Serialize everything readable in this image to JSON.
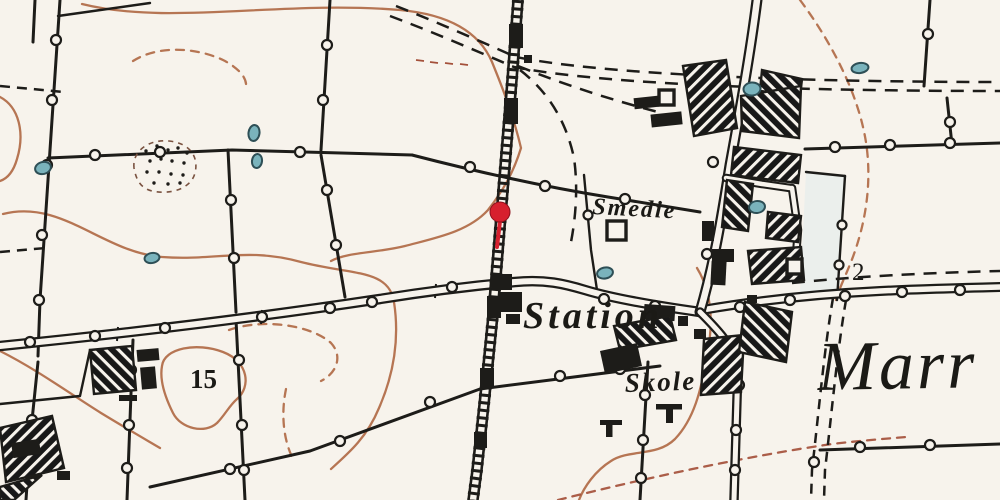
{
  "map": {
    "labels": {
      "smedie": "Smedie",
      "station": "Station",
      "skole": "Skole",
      "place_partial": "Marr",
      "field_number": "15",
      "road_number": "2"
    },
    "colors": {
      "paper": "#f7f3ec",
      "ink": "#1d1c19",
      "contour": "#b06a45",
      "contour_red": "#a4503a",
      "water_fill": "#7ab3bc",
      "water_outline": "#2e4f56",
      "tint": "#e2ebed",
      "marker": "#d7202e"
    }
  }
}
